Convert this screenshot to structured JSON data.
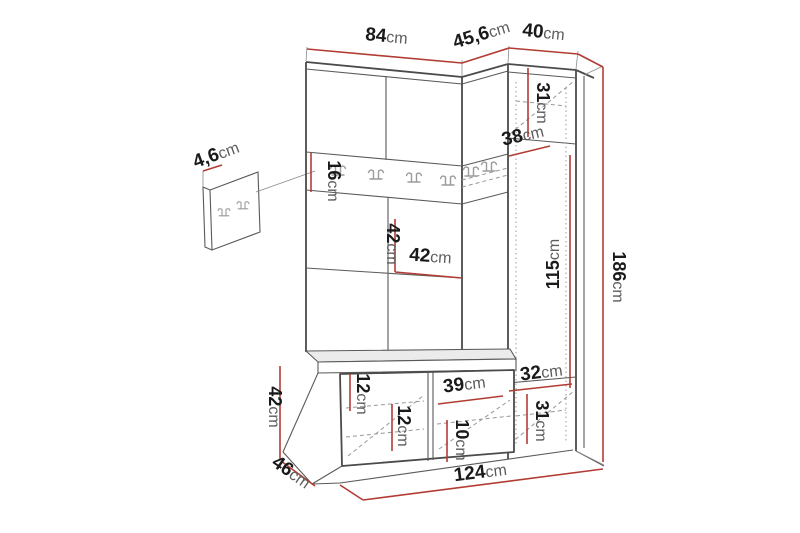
{
  "drawing": {
    "type": "furniture-dimension-diagram",
    "subject": "hallway-wardrobe-set-with-coat-rack-bench-and-tall-cabinet",
    "accent_color": "#b23c34",
    "line_color": "#4b4b4b",
    "background_color": "#ffffff"
  },
  "dims": {
    "main_width": {
      "value": "84",
      "unit": "cm"
    },
    "corner_top_depth": {
      "value": "45,6",
      "unit": "cm"
    },
    "column_width": {
      "value": "40",
      "unit": "cm"
    },
    "wall_panel_thickness": {
      "value": "4,6",
      "unit": "cm"
    },
    "rail_height": {
      "value": "16",
      "unit": "cm"
    },
    "open_section_height": {
      "value": "42",
      "unit": "cm"
    },
    "shelf_width": {
      "value": "42",
      "unit": "cm"
    },
    "column_top_height": {
      "value": "31",
      "unit": "cm"
    },
    "corner_shelf_depth": {
      "value": "38",
      "unit": "cm"
    },
    "column_mid_height": {
      "value": "115",
      "unit": "cm"
    },
    "total_height": {
      "value": "186",
      "unit": "cm"
    },
    "column_shelf_width": {
      "value": "32",
      "unit": "cm"
    },
    "column_bottom_height": {
      "value": "31",
      "unit": "cm"
    },
    "bench_top_gap": {
      "value": "12",
      "unit": "cm"
    },
    "bench_mid_gap": {
      "value": "12",
      "unit": "cm"
    },
    "bench_right_width": {
      "value": "39",
      "unit": "cm"
    },
    "bench_bottom_gap": {
      "value": "10",
      "unit": "cm"
    },
    "bench_height": {
      "value": "42",
      "unit": "cm"
    },
    "bench_depth": {
      "value": "46",
      "unit": "cm"
    },
    "total_width": {
      "value": "124",
      "unit": "cm"
    }
  }
}
